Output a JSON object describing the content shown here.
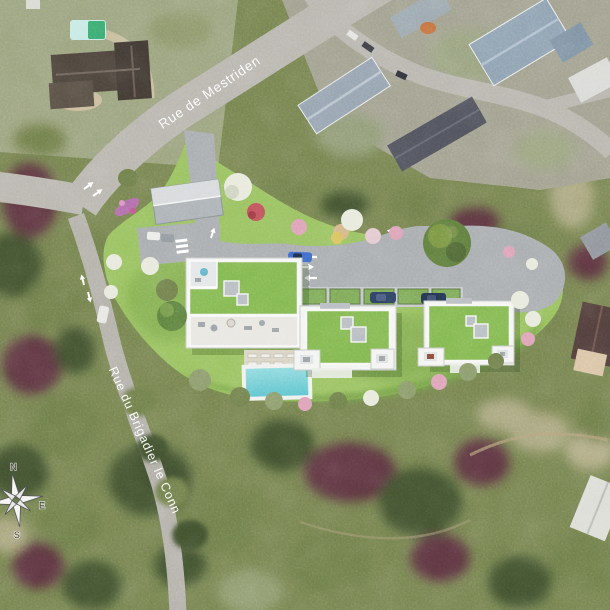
{
  "map": {
    "street_labels": [
      {
        "name": "Rue de Mestriden"
      },
      {
        "name": "Rue du Brigadier le Conn"
      }
    ],
    "compass": {
      "north": "N",
      "east": "E",
      "south": "S"
    },
    "colors": {
      "lawn": "#96c05e",
      "lawn_dark": "#6f9c44",
      "roof_green": "#7fb64e",
      "building_white": "#f4f5f2",
      "road": "#a7abae",
      "road_sat": "#b7b4ad",
      "pool": "#6fcfd6",
      "car_navy": "#2c3e5e",
      "car_blue": "#3a66c8",
      "tree_pink": "#dda0b6",
      "tree_white": "#e7e9dc",
      "bush_red": "#c05158",
      "veg_dark": "#41502e",
      "veg_olive": "#6d7c49",
      "veg_maroon": "#5c3640",
      "veg_khaki": "#a9a67e",
      "label_color": "#ffffff"
    }
  }
}
